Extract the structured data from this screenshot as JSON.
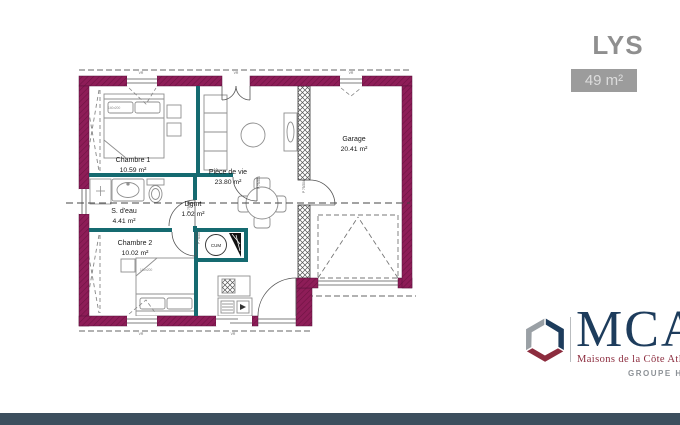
{
  "header": {
    "title": "LYS",
    "area_badge": "49 m²"
  },
  "plan": {
    "rooms": [
      {
        "name": "Chambre 1",
        "area": "10.59 m²"
      },
      {
        "name": "S. d'eau",
        "area": "4.41 m²"
      },
      {
        "name": "Chambre 2",
        "area": "10.02 m²"
      },
      {
        "name": "Dgmt",
        "area": "1.02 m²"
      },
      {
        "name": "Pièce de vie",
        "area": "23.80 m²"
      },
      {
        "name": "Garage",
        "area": "20.41 m²"
      }
    ],
    "annotations": {
      "water_heater": "CUM",
      "door_code": "P 75/204",
      "bed_size": "140x200",
      "window_code": "VR"
    },
    "colors": {
      "exterior_wall": "#8e1d58",
      "interior_wall": "#156a70",
      "hatch_wall_stroke": "#444444",
      "footer_bar": "#3c4f5e"
    }
  },
  "logo": {
    "brand": "MCA",
    "tagline": "Maisons de la Côte Atlantique",
    "group_label": "GROUPE HEXA",
    "brand_color": "#1d3c5c",
    "tagline_color": "#8c2c3e",
    "cube_colors": {
      "navy": "#1d3c5c",
      "maroon": "#8c2c3e",
      "gray": "#9aa0a5"
    }
  }
}
